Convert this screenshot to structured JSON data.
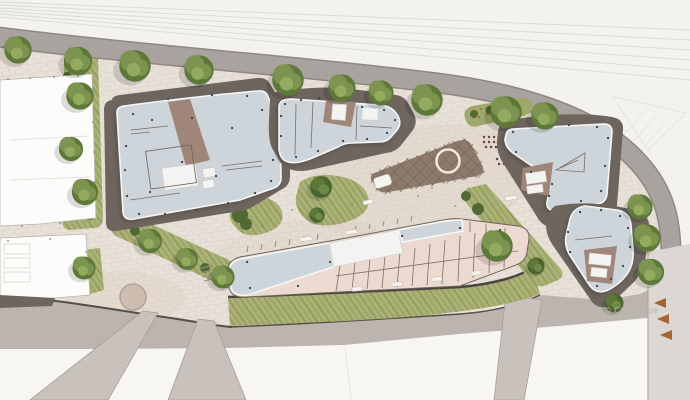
{
  "meta": {
    "title": "Architectural site plan rendering",
    "type": "architectural-masterplan-aerial-view"
  },
  "watermark": {
    "text": "© CG Gruppe"
  },
  "scene": {
    "new_buildings": 5,
    "existing_buildings_west": 2,
    "street_trees_along_road": 10,
    "central_feature": "sunken plaza with circular ring",
    "ramp_arrows": {
      "count": 3,
      "direction": "left"
    }
  },
  "palette": {
    "canvas": "#f3f2ef",
    "foreground": "#f7f6f3",
    "railway_line": "#dcd9d4",
    "sketch_line": "#e6e3de",
    "road": "#a9a3a0",
    "road_edge": "#8e8884",
    "pavement": "#e8e2da",
    "pavement_joint": "#d9d1c6",
    "pavement_tint": "#ddcbbd",
    "concrete": "#bcb5af",
    "site_edge": "#554f49",
    "ramp": "#c9c1bb",
    "ramp_edge": "#a79e97",
    "ramp_strip": "#dcd7d2",
    "white_building": "#fcfcfa",
    "outline": "#b7b1aa",
    "plinth": "#6e655e",
    "roof": "#cdd5db",
    "roof_rim": "#f5f7f7",
    "roof_white": "#f3f4f2",
    "floor": "#ecdad1",
    "wall": "#6f6359",
    "courtyard": "#9f8679",
    "lawn": "#9fa86b",
    "lawn_light": "#b7bd82",
    "lawn_dark": "#87914f",
    "tree": "#7c944f",
    "tree_light": "#93ab5f",
    "tree_dark": "#5d7839",
    "shrub": "#4f6a34",
    "sunken": "#8d7a6d",
    "sunken_line": "#776757",
    "sunken_rim": "#e2d9cf",
    "ring": "#efeae2",
    "dot": "#41464a",
    "maroon_dot": "#6e4038",
    "red_dot": "#a0522d",
    "arrow": "#a86434",
    "watermark": "#b7b2ac",
    "grass_wall": "#4a453f"
  }
}
